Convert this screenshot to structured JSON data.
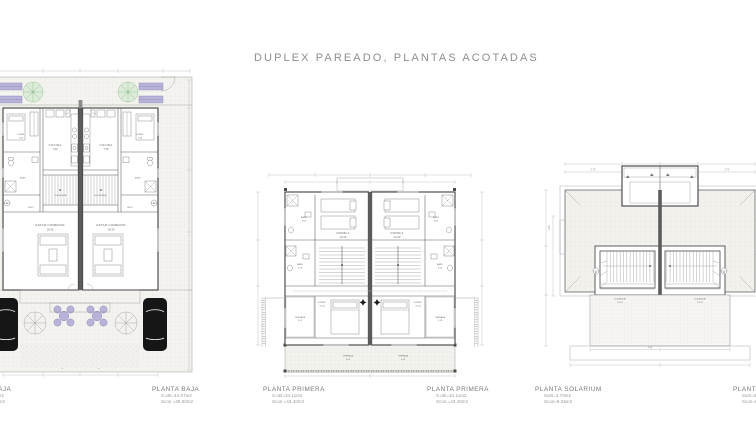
{
  "page": {
    "title": "DUPLEX PAREADO, PLANTAS ACOTADAS",
    "background": "#ffffff",
    "accent_green": "#dcecd8",
    "accent_lavender": "#b7b3d9",
    "accent_red": "#dd7a6e",
    "car_color": "#161616"
  },
  "plans": {
    "baja": {
      "name": "PLANTA BAJA",
      "rooms": {
        "cocina": "COCINA",
        "cocina_area": "7.00",
        "dorm": "DORM.",
        "dorm_area": "7.65",
        "aseo": "ASEO",
        "escalera": "ESCALERA",
        "vest": "VEST.",
        "estar": "ESTAR-COMEDOR",
        "estar_area": "18.35"
      },
      "section_marker": "A3"
    },
    "primera": {
      "name": "PLANTA PRIMERA",
      "rooms": {
        "dorm2": "DORM.2",
        "dorm2_area": "10.20",
        "dorm1": "DORM.1",
        "dorm1_area": "11.40",
        "bano_sup": "BAÑO",
        "bano_sup_area": "4.00",
        "bano": "BAÑO",
        "bano_area": "4.15",
        "terraza_lat": "TERRAZA",
        "terraza_lat_area": "3.15",
        "terraza": "TERRAZA",
        "terraza_area": "5.20"
      }
    },
    "solarium": {
      "name": "PLANTA SOLARIUM",
      "rooms": {
        "solarium": "SOLARIUM",
        "solarium_area": "10.70"
      },
      "dims": {
        "left": "2.75",
        "right": "2.75",
        "bottom": "4.04",
        "side": "1.50"
      },
      "section_marker": "A3"
    }
  },
  "footers": [
    {
      "title": "PLANTA BAJA",
      "util": "S.util=43.07m2",
      "cons": "Scon.=49.60m2"
    },
    {
      "title": "PLANTA BAJA",
      "util": "S.util=43.07m2",
      "cons": "Scon.=49.60m2"
    },
    {
      "title": "PLANTA PRIMERA",
      "util": "S.util=34.11m2",
      "cons": "Scon.=43.40m2"
    },
    {
      "title": "PLANTA PRIMERA",
      "util": "S.util=34.11m2",
      "cons": "Scon.=43.40m2"
    },
    {
      "title": "PLANTA SOLARIUM",
      "util": "Sutil=3.70m2",
      "cons": "Scon=8.05m2"
    },
    {
      "title": "PLANTA SOLARIUM",
      "util": "Sutil=3.70m2",
      "cons": "Scon=8.05m2"
    }
  ]
}
